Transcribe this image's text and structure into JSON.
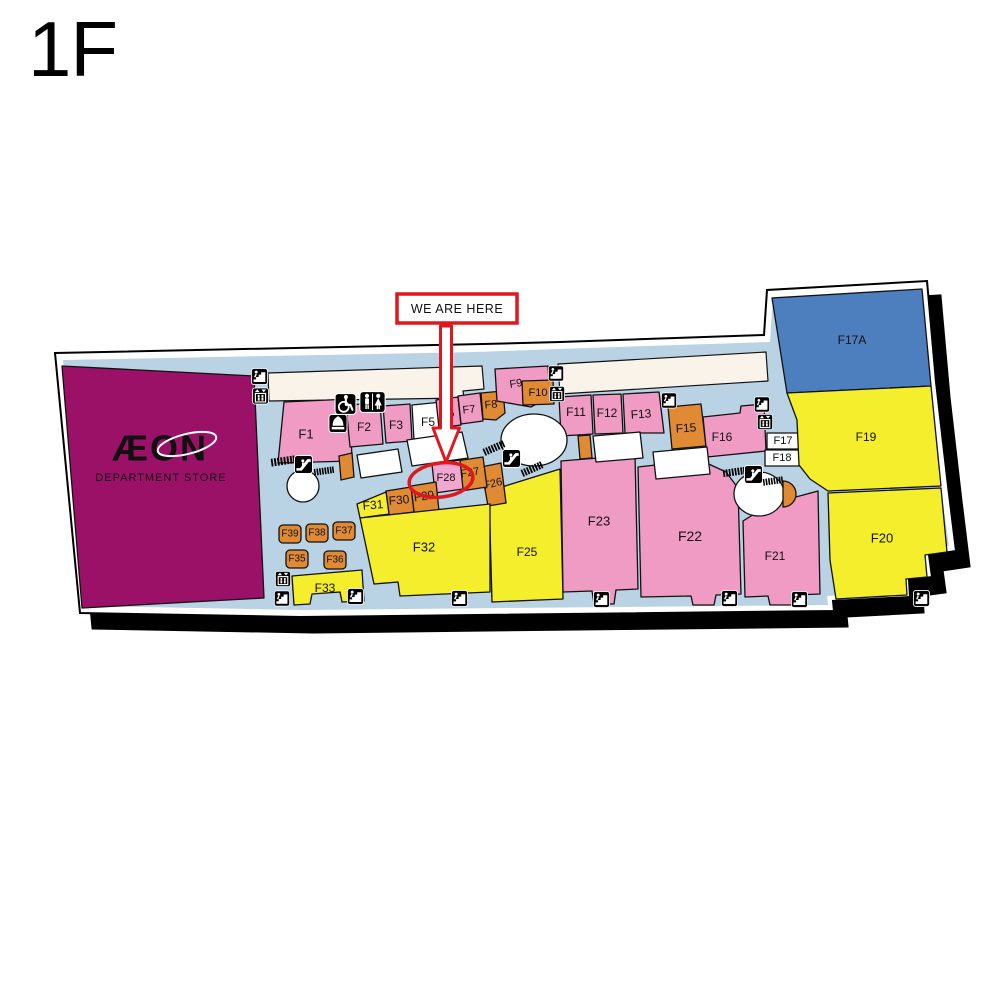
{
  "page": {
    "floor_label": "1F"
  },
  "annotation": {
    "label": "WE ARE HERE",
    "highlighted_unit": "F28",
    "color": "#e0171e"
  },
  "anchor": {
    "name": "ÆON",
    "subtitle": "DEPARTMENT STORE",
    "fill": "#9c1168"
  },
  "colors": {
    "walkway": "#b9d3e4",
    "platform": "#ffffff",
    "shadow": "#000000",
    "corridor_strip": "#faf3ea",
    "outline": "#111111",
    "pink": "#ef9bc4",
    "orange": "#e08a33",
    "yellow": "#f4ee2c",
    "blue": "#4d7fbe"
  },
  "icons": {
    "stairs": {
      "name": "stairs-icon",
      "count": 11
    },
    "elevator": {
      "name": "elevator-icon",
      "count": 4
    },
    "escalator": {
      "name": "escalator-icon",
      "count": 3
    },
    "toilets": {
      "name": "toilets-icon",
      "count": 1
    },
    "accessible_toilet": {
      "name": "accessible-toilet-icon",
      "count": 1
    },
    "prayer_room": {
      "name": "prayer-room-icon",
      "count": 1
    }
  },
  "units": {
    "F1": {
      "label": "F1",
      "fill": "#ef9bc4"
    },
    "F2": {
      "label": "F2",
      "fill": "#ef9bc4"
    },
    "F3": {
      "label": "F3",
      "fill": "#ef9bc4"
    },
    "F5": {
      "label": "F5",
      "fill": "#ffffff"
    },
    "F6": {
      "label": "F6",
      "fill": "#ef9bc4"
    },
    "F7": {
      "label": "F7",
      "fill": "#ef9bc4"
    },
    "F8": {
      "label": "F8",
      "fill": "#e08a33"
    },
    "F9": {
      "label": "F9",
      "fill": "#ef9bc4"
    },
    "F10": {
      "label": "F10",
      "fill": "#e08a33"
    },
    "F11": {
      "label": "F11",
      "fill": "#ef9bc4"
    },
    "F12": {
      "label": "F12",
      "fill": "#ef9bc4"
    },
    "F13": {
      "label": "F13",
      "fill": "#ef9bc4"
    },
    "F15": {
      "label": "F15",
      "fill": "#e08a33"
    },
    "F16": {
      "label": "F16",
      "fill": "#ef9bc4"
    },
    "F17": {
      "label": "F17",
      "fill": "#ffffff"
    },
    "F18": {
      "label": "F18",
      "fill": "#ffffff"
    },
    "F17A": {
      "label": "F17A",
      "fill": "#4d7fbe"
    },
    "F19": {
      "label": "F19",
      "fill": "#f4ee2c"
    },
    "F20": {
      "label": "F20",
      "fill": "#f4ee2c"
    },
    "F21": {
      "label": "F21",
      "fill": "#ef9bc4"
    },
    "F22": {
      "label": "F22",
      "fill": "#ef9bc4"
    },
    "F23": {
      "label": "F23",
      "fill": "#ef9bc4"
    },
    "F25": {
      "label": "F25",
      "fill": "#f4ee2c"
    },
    "F26": {
      "label": "F26",
      "fill": "#e08a33"
    },
    "F27": {
      "label": "F27",
      "fill": "#e08a33"
    },
    "F28": {
      "label": "F28",
      "fill": "#f2a7d0"
    },
    "F29": {
      "label": "F29",
      "fill": "#e08a33"
    },
    "F30": {
      "label": "F30",
      "fill": "#e08a33"
    },
    "F31": {
      "label": "F31",
      "fill": "#f4ee2c"
    },
    "F32": {
      "label": "F32",
      "fill": "#f4ee2c"
    },
    "F33": {
      "label": "F33",
      "fill": "#f4ee2c"
    },
    "F35": {
      "label": "F35",
      "fill": "#e08a33"
    },
    "F36": {
      "label": "F36",
      "fill": "#e08a33"
    },
    "F37": {
      "label": "F37",
      "fill": "#e08a33"
    },
    "F38": {
      "label": "F38",
      "fill": "#e08a33"
    },
    "F39": {
      "label": "F39",
      "fill": "#e08a33"
    }
  }
}
